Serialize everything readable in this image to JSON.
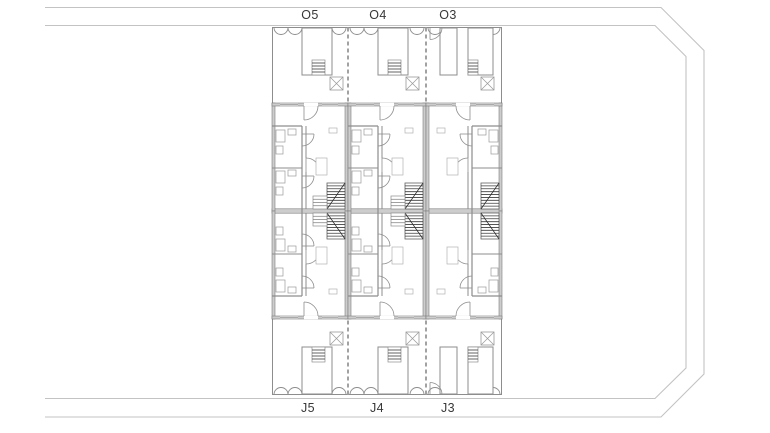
{
  "page": {
    "width": 770,
    "height": 433,
    "background": "#ffffff"
  },
  "colors": {
    "boundary_line": "#c3c3c3",
    "wall_fill": "#cdcdcd",
    "wall_edge": "#7c7c7c",
    "thin_line": "#8d8d8d",
    "light_line": "#b2b2b2",
    "dark_detail": "#3d3d3d",
    "dashed_line": "#a2a2a2",
    "fixture_line": "#9a9a9a",
    "label_text": "#383838"
  },
  "road": {
    "top_labels": [
      {
        "text": "O5"
      },
      {
        "text": "O4"
      },
      {
        "text": "O3"
      }
    ],
    "bottom_labels": [
      {
        "text": "J5"
      },
      {
        "text": "J4"
      },
      {
        "text": "J3"
      }
    ]
  },
  "units": [
    {
      "top_label": "O5",
      "bottom_label": "J5",
      "x": 272,
      "w": 76,
      "variant": "a"
    },
    {
      "top_label": "O4",
      "bottom_label": "J4",
      "x": 348,
      "w": 78,
      "variant": "a"
    },
    {
      "top_label": "O3",
      "bottom_label": "J3",
      "x": 426,
      "w": 76,
      "variant": "b"
    }
  ]
}
